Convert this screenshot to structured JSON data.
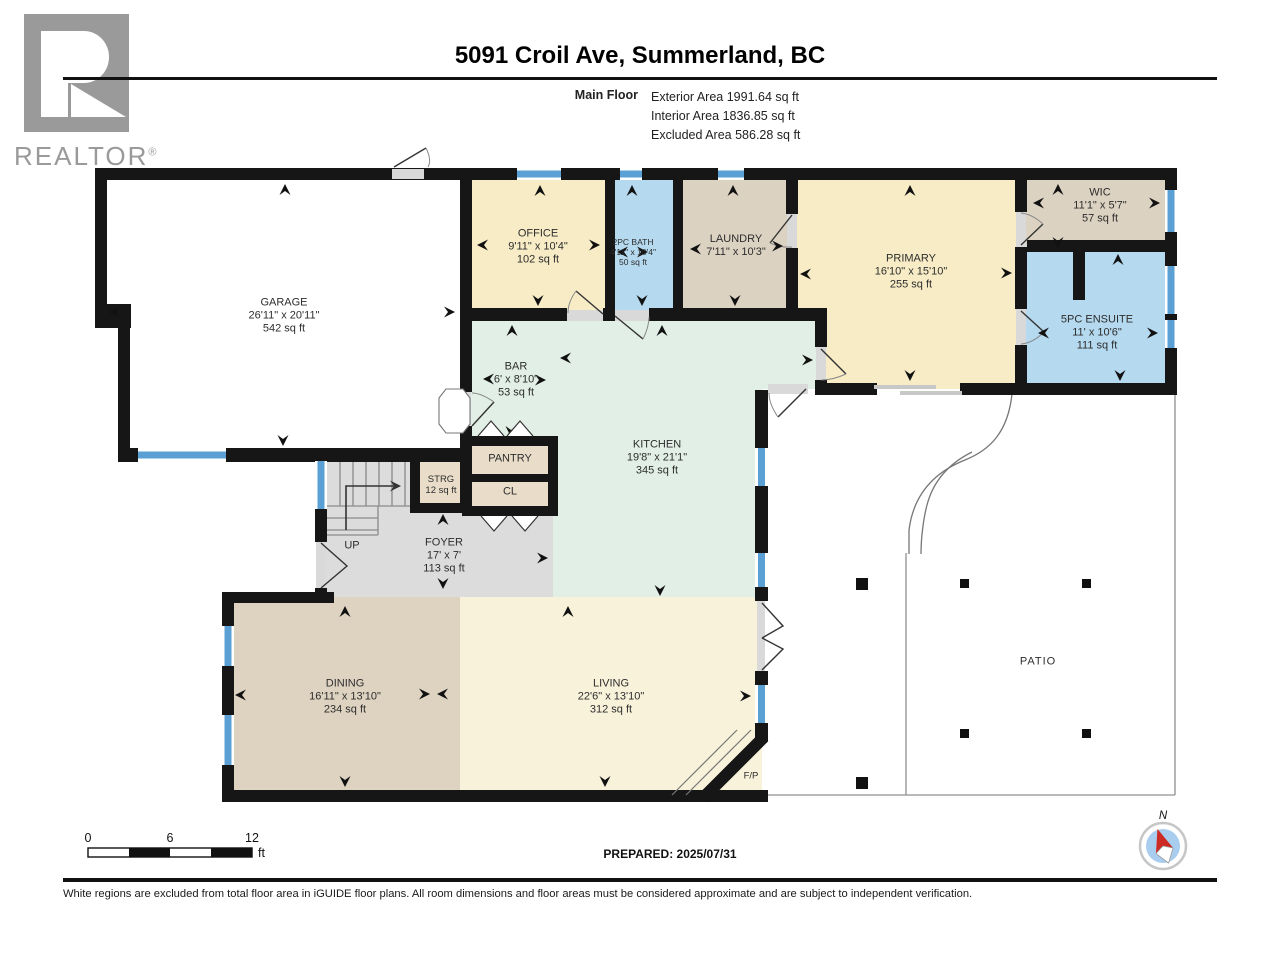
{
  "header": {
    "title": "5091 Croil Ave, Summerland, BC",
    "floor_label": "Main Floor",
    "areas": [
      "Exterior Area 1991.64 sq ft",
      "Interior Area 1836.85 sq ft",
      "Excluded Area 586.28 sq ft"
    ]
  },
  "logo": {
    "text": "REALTOR",
    "reg": "®"
  },
  "rooms": {
    "garage": {
      "name": "GARAGE",
      "dims": "26'11\" x 20'11\"",
      "area": "542 sq ft"
    },
    "office": {
      "name": "OFFICE",
      "dims": "9'11\" x 10'4\"",
      "area": "102 sq ft"
    },
    "bath2pc": {
      "name": "2PC BATH",
      "dims": "4'11\" x 10'4\"",
      "area": "50 sq ft"
    },
    "laundry": {
      "name": "LAUNDRY",
      "dims": "7'11\" x 10'3\""
    },
    "primary": {
      "name": "PRIMARY",
      "dims": "16'10\" x 15'10\"",
      "area": "255 sq ft"
    },
    "wic": {
      "name": "WIC",
      "dims": "11'1\" x 5'7\"",
      "area": "57 sq ft"
    },
    "ensuite": {
      "name": "5PC ENSUITE",
      "dims": "11' x 10'6\"",
      "area": "111 sq ft"
    },
    "bar": {
      "name": "BAR",
      "dims": "6' x 8'10\"",
      "area": "53 sq ft"
    },
    "kitchen": {
      "name": "KITCHEN",
      "dims": "19'8\" x 21'1\"",
      "area": "345 sq ft"
    },
    "pantry": {
      "name": "PANTRY"
    },
    "closet": {
      "name": "CL"
    },
    "storage": {
      "name": "STRG",
      "area": "12 sq ft"
    },
    "foyer": {
      "name": "FOYER",
      "dims": "17' x 7'",
      "area": "113 sq ft"
    },
    "stairs": {
      "name": "UP"
    },
    "dining": {
      "name": "DINING",
      "dims": "16'11\" x 13'10\"",
      "area": "234 sq ft"
    },
    "living": {
      "name": "LIVING",
      "dims": "22'6\" x 13'10\"",
      "area": "312 sq ft"
    },
    "fireplace": {
      "name": "F/P"
    },
    "patio": {
      "name": "PATIO"
    }
  },
  "scale_bar": {
    "tick_start": "0",
    "tick_mid": "6",
    "tick_end": "12",
    "unit": "ft"
  },
  "prepared": "PREPARED: 2025/07/31",
  "compass": {
    "north": "N"
  },
  "footer": "White regions are excluded from total floor area in iGUIDE floor plans. All room dimensions and floor areas must be considered approximate and are subject to independent verification.",
  "colors": {
    "room_cream": "#f7ecc6",
    "room_blue": "#b5d9ef",
    "room_tan": "#dcd2c2",
    "room_mint": "#e1efe6",
    "room_closet": "#e9ddc9",
    "room_foyer_gray": "#dcdcdc",
    "room_dining": "#ded3c1",
    "room_living": "#f8f2da",
    "window_blue": "#5ba0d5",
    "wall_black": "#161616",
    "compass_red": "#cc2a22",
    "compass_blue": "#a9cdee",
    "logo_gray": "#9a9a9a"
  }
}
